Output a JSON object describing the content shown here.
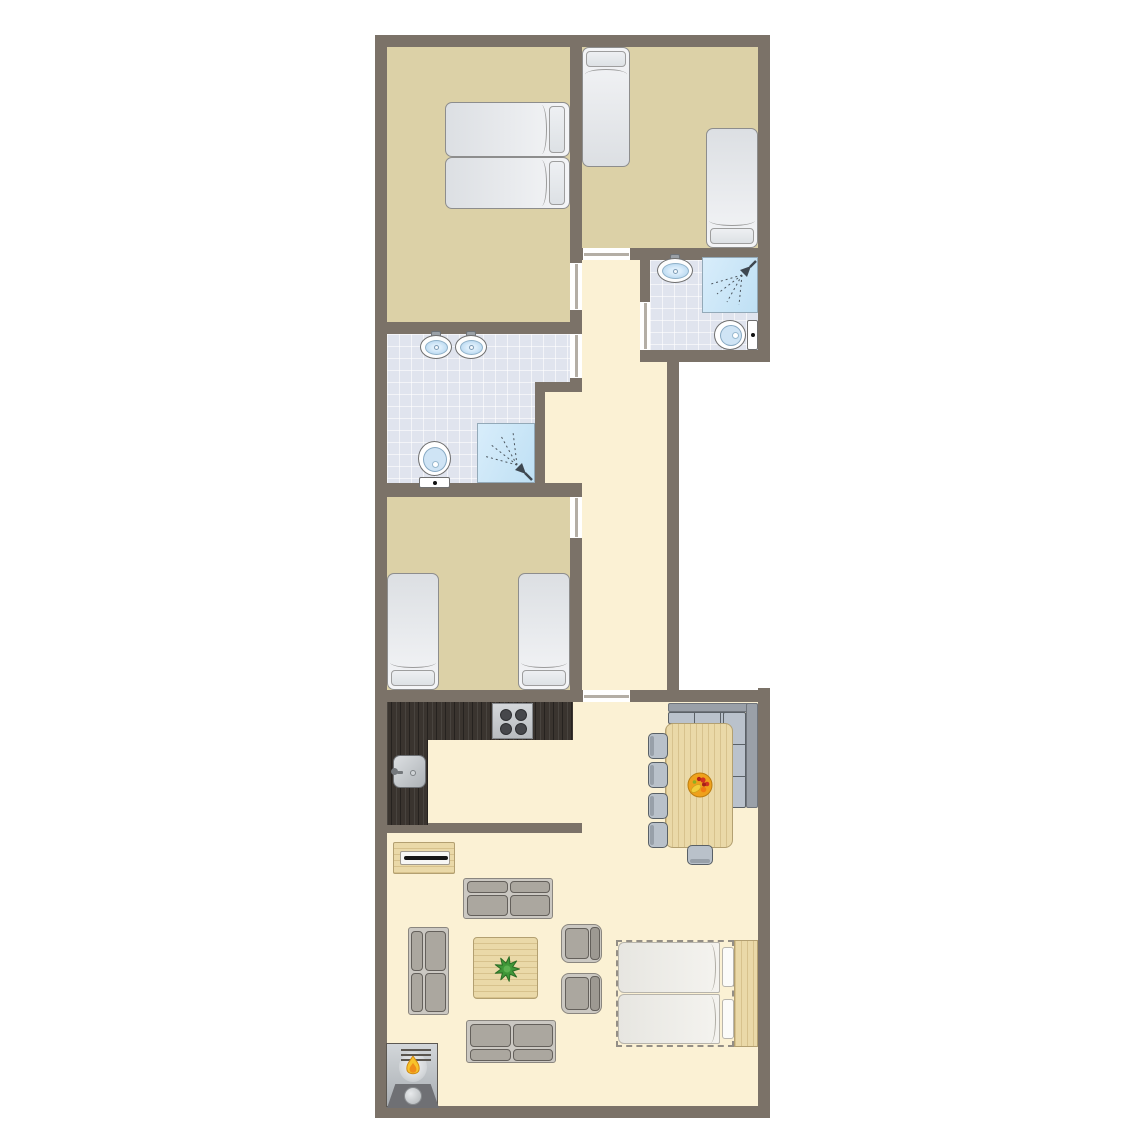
{
  "meta": {
    "title": "apartment-floor-plan",
    "canvas": {
      "w": 1145,
      "h": 1145
    }
  },
  "palette": {
    "wall": "#7b7268",
    "floorTan": "#dcd1a7",
    "floorCream": "#fbf1d4",
    "tileBase": "#e0e4ee",
    "doorLeaf": "#b4aea5",
    "counterDark": "#3a342f",
    "wood": "#ead9a8",
    "woodEdge": "#b3a071",
    "sofaCushion": "#aba79f",
    "sofaFrame": "#cbc8c2",
    "benchSeat": "#bac2cc",
    "benchBack": "#9aa0a8",
    "chairBlue": "#b9c1ca",
    "basinBlue": "#a9cfec",
    "showerBlue": "#bfe0f4",
    "flameYellow": "#f7c32b",
    "flameOrange": "#ef8d1a",
    "plantGreen": "#3f9738",
    "fruitOrange": "#efa11c",
    "fruitRed": "#d23121",
    "fruitYellow": "#f2cd3a"
  },
  "floors": [
    {
      "name": "bedroom-1-floor",
      "kind": "tan",
      "x": 387,
      "y": 47,
      "w": 183,
      "h": 275
    },
    {
      "name": "bedroom-2-floor",
      "kind": "tan",
      "x": 582,
      "y": 47,
      "w": 176,
      "h": 201
    },
    {
      "name": "bathroom-1-floor-a",
      "kind": "tile",
      "x": 387,
      "y": 334,
      "w": 183,
      "h": 48
    },
    {
      "name": "bathroom-1-floor-b",
      "kind": "tile",
      "x": 387,
      "y": 382,
      "w": 148,
      "h": 101
    },
    {
      "name": "bathroom-2-floor",
      "kind": "tile",
      "x": 650,
      "y": 260,
      "w": 108,
      "h": 90
    },
    {
      "name": "bedroom-3-floor",
      "kind": "tan",
      "x": 387,
      "y": 497,
      "w": 183,
      "h": 193
    },
    {
      "name": "hallway-floor-a",
      "kind": "cream",
      "x": 582,
      "y": 260,
      "w": 58,
      "h": 102
    },
    {
      "name": "hallway-floor-b",
      "kind": "cream",
      "x": 582,
      "y": 362,
      "w": 85,
      "h": 328
    },
    {
      "name": "hallway-floor-c",
      "kind": "cream",
      "x": 545,
      "y": 392,
      "w": 37,
      "h": 91
    },
    {
      "name": "living-room-floor",
      "kind": "cream",
      "x": 387,
      "y": 702,
      "w": 371,
      "h": 404
    }
  ],
  "walls": [
    {
      "x": 375,
      "y": 35,
      "w": 395,
      "h": 12
    },
    {
      "x": 375,
      "y": 35,
      "w": 12,
      "h": 1083
    },
    {
      "x": 758,
      "y": 35,
      "w": 12,
      "h": 327
    },
    {
      "x": 375,
      "y": 1106,
      "w": 395,
      "h": 12
    },
    {
      "x": 758,
      "y": 688,
      "w": 12,
      "h": 430
    },
    {
      "x": 570,
      "y": 47,
      "w": 12,
      "h": 216
    },
    {
      "x": 570,
      "y": 310,
      "w": 12,
      "h": 24
    },
    {
      "x": 570,
      "y": 378,
      "w": 12,
      "h": 14
    },
    {
      "x": 570,
      "y": 483,
      "w": 12,
      "h": 14
    },
    {
      "x": 570,
      "y": 538,
      "w": 12,
      "h": 164
    },
    {
      "x": 375,
      "y": 322,
      "w": 207,
      "h": 12
    },
    {
      "x": 570,
      "y": 248,
      "w": 13,
      "h": 12
    },
    {
      "x": 630,
      "y": 248,
      "w": 140,
      "h": 12
    },
    {
      "x": 640,
      "y": 260,
      "w": 10,
      "h": 42
    },
    {
      "x": 640,
      "y": 350,
      "w": 130,
      "h": 12
    },
    {
      "x": 667,
      "y": 362,
      "w": 12,
      "h": 338
    },
    {
      "x": 375,
      "y": 483,
      "w": 207,
      "h": 14
    },
    {
      "x": 535,
      "y": 382,
      "w": 47,
      "h": 10
    },
    {
      "x": 535,
      "y": 382,
      "w": 10,
      "h": 101
    },
    {
      "x": 375,
      "y": 690,
      "w": 208,
      "h": 12
    },
    {
      "x": 630,
      "y": 690,
      "w": 140,
      "h": 12
    },
    {
      "x": 375,
      "y": 823,
      "w": 207,
      "h": 10
    }
  ],
  "doors": [
    {
      "name": "door-bedroom-1",
      "x": 570,
      "y": 263,
      "w": 12,
      "h": 47,
      "leaf": "v"
    },
    {
      "name": "door-bathroom-1",
      "x": 570,
      "y": 334,
      "w": 12,
      "h": 44,
      "leaf": "v"
    },
    {
      "name": "door-bedroom-3",
      "x": 570,
      "y": 497,
      "w": 12,
      "h": 41,
      "leaf": "v"
    },
    {
      "name": "door-bathroom-2",
      "x": 640,
      "y": 302,
      "w": 10,
      "h": 48,
      "leaf": "v"
    },
    {
      "name": "door-bedroom-2",
      "x": 583,
      "y": 248,
      "w": 47,
      "h": 12,
      "leaf": "h"
    },
    {
      "name": "door-hallway-living",
      "x": 583,
      "y": 690,
      "w": 47,
      "h": 12,
      "leaf": "h"
    }
  ],
  "furniture": [
    {
      "type": "bed",
      "name": "bed-double-top",
      "x": 445,
      "y": 102,
      "w": 125,
      "h": 55,
      "pillow": "right"
    },
    {
      "type": "bed",
      "name": "bed-double-bottom",
      "x": 445,
      "y": 157,
      "w": 125,
      "h": 52,
      "pillow": "right"
    },
    {
      "type": "bed",
      "name": "bed-single-left",
      "x": 582,
      "y": 47,
      "w": 48,
      "h": 120,
      "pillow": "top"
    },
    {
      "type": "bed",
      "name": "bed-single-right",
      "x": 706,
      "y": 128,
      "w": 52,
      "h": 120,
      "pillow": "bottom"
    },
    {
      "type": "bed",
      "name": "bed-twin-left",
      "x": 387,
      "y": 573,
      "w": 52,
      "h": 117,
      "pillow": "bottom"
    },
    {
      "type": "bed",
      "name": "bed-twin-right",
      "x": 518,
      "y": 573,
      "w": 52,
      "h": 117,
      "pillow": "bottom"
    },
    {
      "type": "sink",
      "name": "washbasin",
      "x": 656,
      "y": 254,
      "w": 38,
      "h": 30
    },
    {
      "type": "shower",
      "name": "shower",
      "x": 702,
      "y": 257,
      "w": 56,
      "h": 56,
      "corner": "tr"
    },
    {
      "type": "toilet-h",
      "name": "toilet",
      "x": 714,
      "y": 320,
      "w": 44,
      "h": 30
    },
    {
      "type": "sink",
      "name": "washbasin",
      "x": 419,
      "y": 331,
      "w": 34,
      "h": 29
    },
    {
      "type": "sink",
      "name": "washbasin",
      "x": 454,
      "y": 331,
      "w": 34,
      "h": 29
    },
    {
      "type": "toilet-v",
      "name": "toilet",
      "x": 418,
      "y": 441,
      "w": 33,
      "h": 47
    },
    {
      "type": "shower",
      "name": "shower",
      "x": 477,
      "y": 423,
      "w": 58,
      "h": 60,
      "corner": "br"
    },
    {
      "type": "counter",
      "name": "kitchen-counter-top",
      "x": 387,
      "y": 702,
      "w": 186,
      "h": 38
    },
    {
      "type": "counter",
      "name": "kitchen-counter-left",
      "x": 387,
      "y": 740,
      "w": 41,
      "h": 85
    },
    {
      "type": "stove",
      "name": "stove",
      "x": 492,
      "y": 703,
      "w": 41,
      "h": 36
    },
    {
      "type": "ksink",
      "name": "kitchen-sink",
      "x": 393,
      "y": 755,
      "w": 33,
      "h": 33
    },
    {
      "type": "bench-back",
      "name": "bench-backrest",
      "x": 668,
      "y": 703,
      "w": 90,
      "h": 9
    },
    {
      "type": "bench-back",
      "name": "bench-backrest",
      "x": 746,
      "y": 703,
      "w": 12,
      "h": 105
    },
    {
      "type": "bench-seat",
      "name": "corner-bench",
      "x": 668,
      "y": 712,
      "w": 78,
      "h": 12,
      "dir": "h"
    },
    {
      "type": "bench-seat",
      "name": "corner-bench",
      "x": 723,
      "y": 712,
      "w": 23,
      "h": 96,
      "dir": "v"
    },
    {
      "type": "wood",
      "name": "dining-table",
      "x": 665,
      "y": 723,
      "w": 68,
      "h": 125,
      "grain": "v",
      "r": 8
    },
    {
      "type": "fruitbowl",
      "name": "fruit-bowl",
      "x": 687,
      "y": 772,
      "w": 26,
      "h": 26
    },
    {
      "type": "chair",
      "name": "dining-chair",
      "x": 648,
      "y": 733,
      "w": 20,
      "h": 26,
      "back": "left"
    },
    {
      "type": "chair",
      "name": "dining-chair",
      "x": 648,
      "y": 762,
      "w": 20,
      "h": 26,
      "back": "left"
    },
    {
      "type": "chair",
      "name": "dining-chair",
      "x": 648,
      "y": 793,
      "w": 20,
      "h": 26,
      "back": "left"
    },
    {
      "type": "chair",
      "name": "dining-chair",
      "x": 648,
      "y": 822,
      "w": 20,
      "h": 26,
      "back": "left"
    },
    {
      "type": "chair",
      "name": "dining-chair",
      "x": 687,
      "y": 845,
      "w": 26,
      "h": 20,
      "back": "bottom"
    },
    {
      "type": "sideboard",
      "name": "tv-sideboard",
      "x": 393,
      "y": 842,
      "w": 62,
      "h": 32
    },
    {
      "type": "sofa",
      "name": "sofa-top",
      "x": 463,
      "y": 878,
      "w": 90,
      "h": 41,
      "back": "top"
    },
    {
      "type": "sofa",
      "name": "sofa-left",
      "x": 408,
      "y": 927,
      "w": 41,
      "h": 88,
      "back": "left"
    },
    {
      "type": "sofa",
      "name": "sofa-bottom",
      "x": 466,
      "y": 1020,
      "w": 90,
      "h": 43,
      "back": "bottom"
    },
    {
      "type": "armchair",
      "name": "armchair",
      "x": 561,
      "y": 924,
      "w": 41,
      "h": 39
    },
    {
      "type": "armchair",
      "name": "armchair",
      "x": 561,
      "y": 973,
      "w": 41,
      "h": 41
    },
    {
      "type": "wood",
      "name": "coffee-table",
      "x": 473,
      "y": 937,
      "w": 65,
      "h": 62,
      "grain": "h",
      "r": 4
    },
    {
      "type": "plant",
      "name": "plant",
      "x": 494,
      "y": 956,
      "w": 26,
      "h": 26
    },
    {
      "type": "fireplace",
      "name": "fireplace",
      "x": 386,
      "y": 1043,
      "w": 52,
      "h": 64
    },
    {
      "type": "sofabed",
      "name": "sofa-bed",
      "x": 616,
      "y": 940,
      "w": 142,
      "h": 107
    }
  ]
}
